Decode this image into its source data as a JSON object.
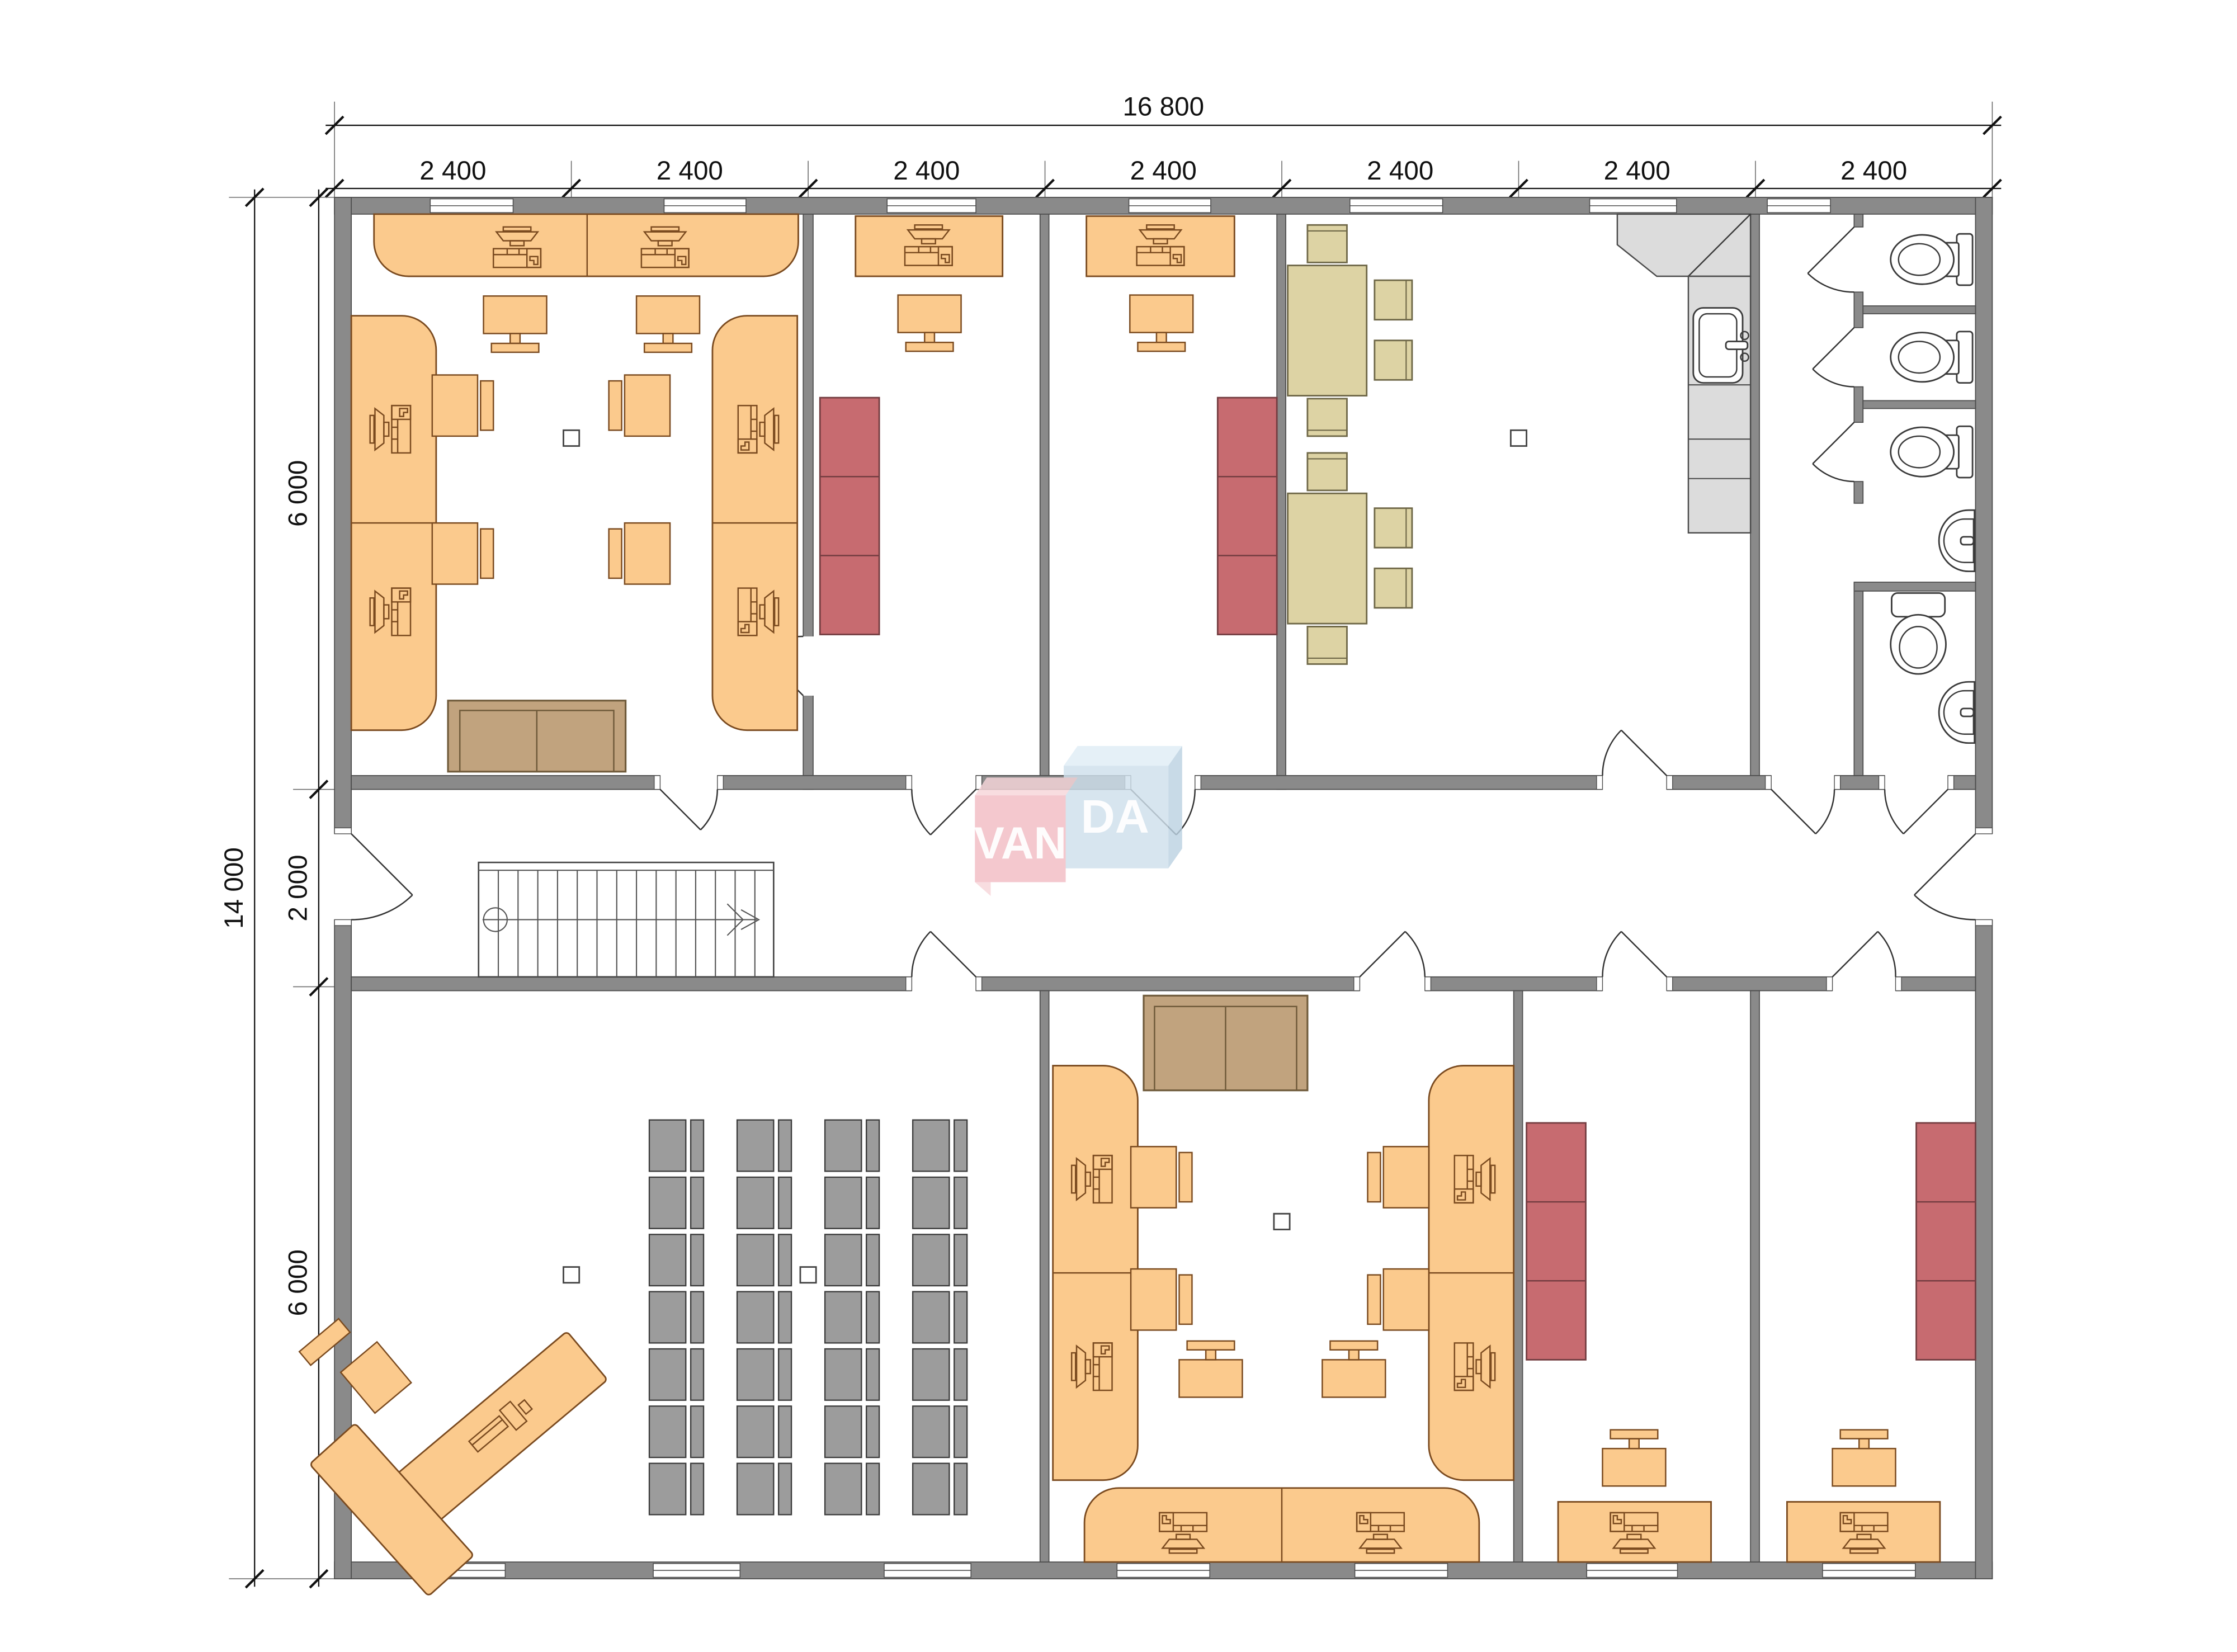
{
  "dimensions": {
    "top": {
      "overall": "16 800",
      "segments": [
        "2 400",
        "2 400",
        "2 400",
        "2 400",
        "2 400",
        "2 400",
        "2 400"
      ]
    },
    "left": {
      "overall": "14 000",
      "segments": [
        "6 000",
        "2 000",
        "6 000"
      ]
    }
  },
  "watermark": {
    "left": "VAN",
    "right": "DA"
  },
  "colors": {
    "wall": "#8a8a8a",
    "desk": "#fbca8d",
    "desk_line": "#7a4a1f",
    "cabinet": "#c76b70",
    "dining": "#ddd3a4",
    "sofa": "#c1a37e",
    "seat_gray": "#9c9c9c",
    "counter": "#dcdcdc",
    "watermark_pink": "#f2bcc4",
    "watermark_blue": "#cfe0ec"
  }
}
